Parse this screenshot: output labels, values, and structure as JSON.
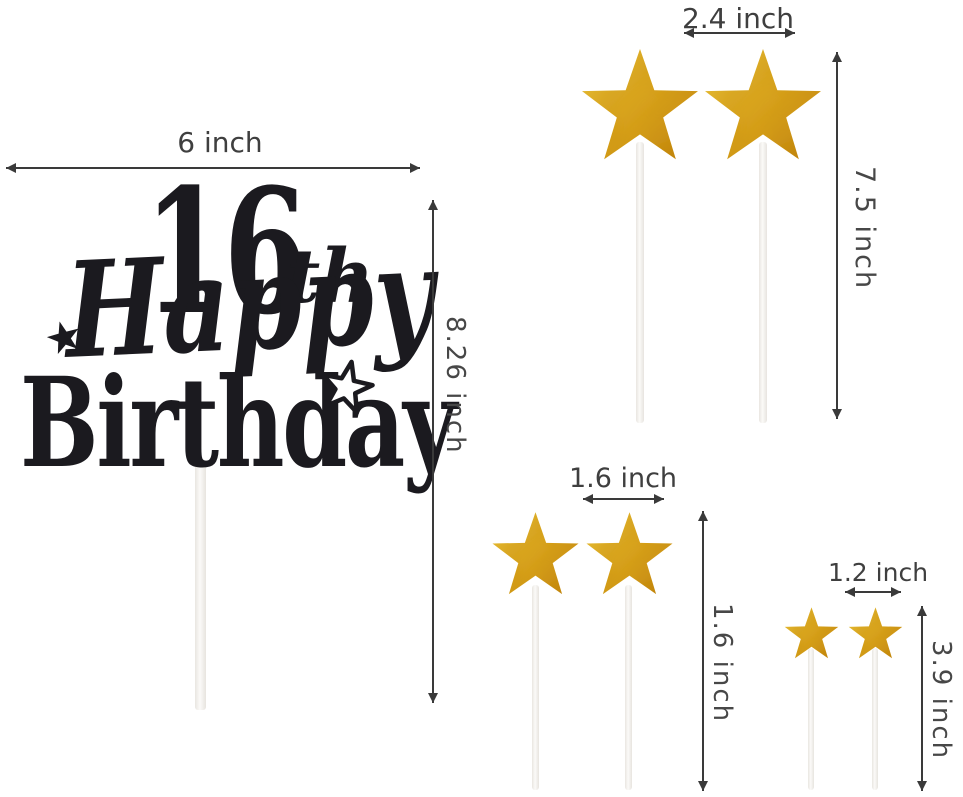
{
  "title": "16th Happy Birthday cake topper with gold star picks - dimension diagram",
  "topper": {
    "number": "16",
    "ordinal_suffix": "th",
    "word_top": "Happy",
    "word_bottom": "Birthday"
  },
  "measurements": {
    "topper_width": "6 inch",
    "topper_total_height": "8.26 inch",
    "large_star_width": "2.4 inch",
    "large_star_total_height": "7.5 inch",
    "medium_star_width": "1.6 inch",
    "medium_star_height": "1.6 inch",
    "small_star_width": "1.2 inch",
    "small_star_total_height": "3.9 inch"
  },
  "star_picks": {
    "large_count": 2,
    "medium_count": 2,
    "small_count": 2
  },
  "colors": {
    "background": "#ffffff",
    "topper_black": "#1b1a1f",
    "star_gold": "#DCA81E",
    "star_gold_light": "#EEC83E",
    "star_gold_dark": "#C6890D",
    "annotation_gray": "#3f3f3f",
    "stick_white": "#f6f4f1"
  }
}
